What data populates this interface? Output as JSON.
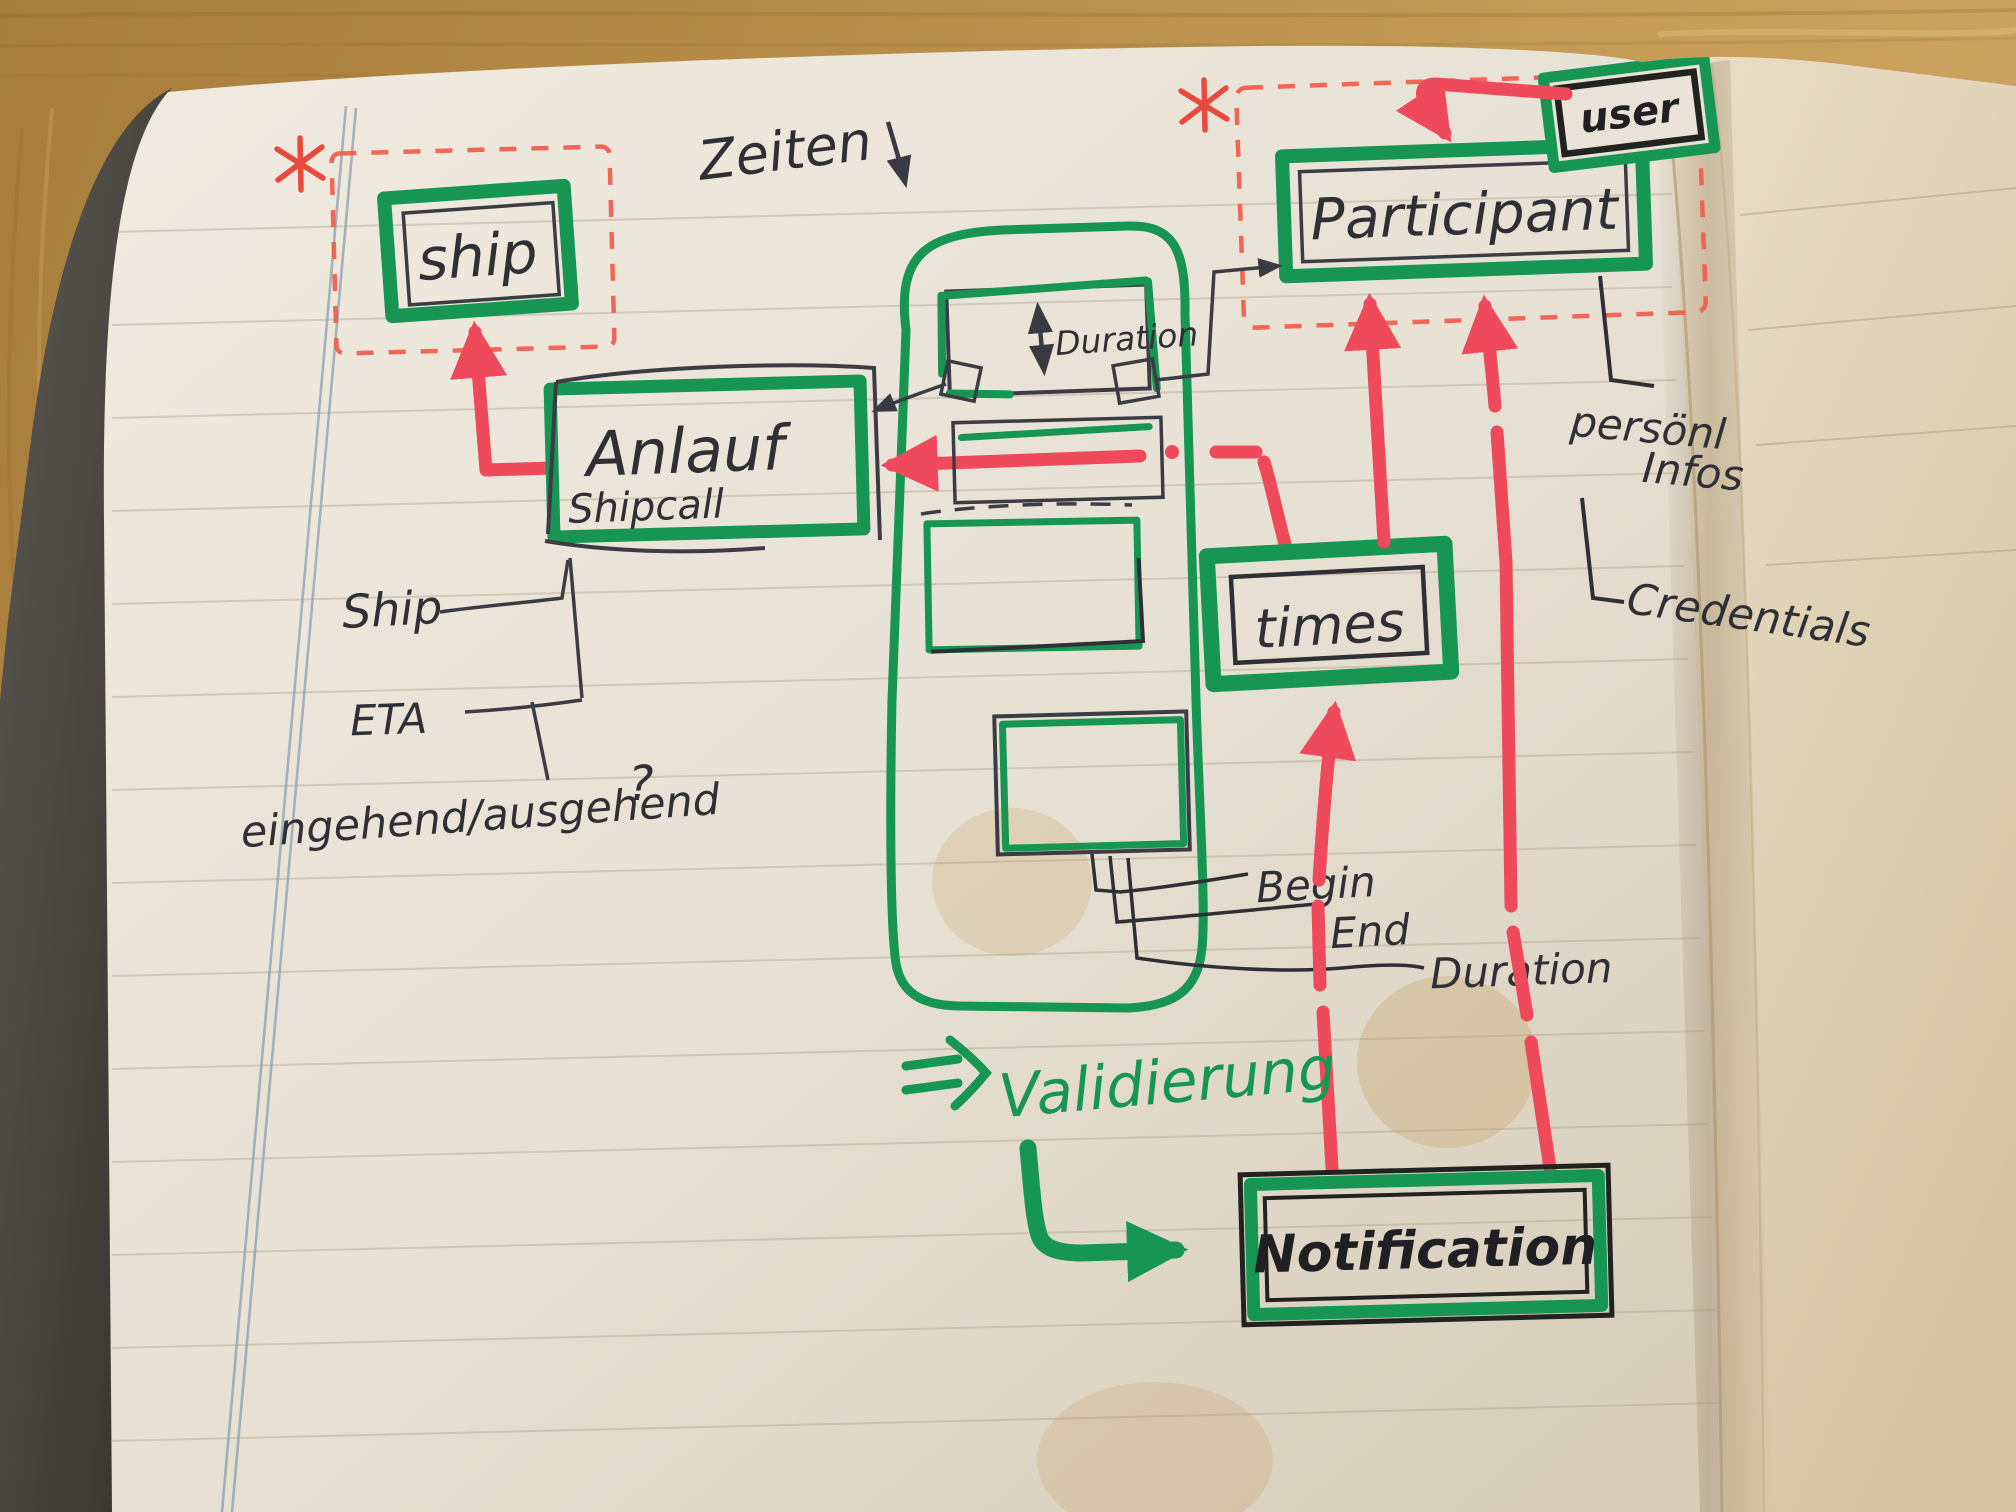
{
  "diagram": {
    "entities": {
      "ship": {
        "label": "ship"
      },
      "participant": {
        "label": "Participant"
      },
      "user": {
        "label": "user"
      },
      "anlauf": {
        "label": "Anlauf",
        "sublabel": "Shipcall"
      },
      "duration_box": {
        "label": "Duration"
      },
      "times": {
        "label": "times"
      },
      "notification": {
        "label": "Notification"
      }
    },
    "annotations": {
      "zeiten": "Zeiten",
      "validierung": "Validierung"
    },
    "attributes": {
      "ship": "Ship",
      "eta": "ETA",
      "in_out": "eingehend/ausgehend",
      "question": "?",
      "begin": "Begin",
      "end": "End",
      "duration": "Duration",
      "persoenl_line1": "persönl",
      "persoenl_line2": "Infos",
      "credentials": "Credentials"
    },
    "marks": {
      "asterisk": "*"
    },
    "colors": {
      "marker_green": "#179553",
      "marker_red": "#ef4a5c",
      "dashed_red": "#f25b4b",
      "ink_black": "#2f2f36",
      "pencil_gray": "#44444c",
      "paper": "#e9e3d7",
      "wood": "#b28744"
    }
  }
}
